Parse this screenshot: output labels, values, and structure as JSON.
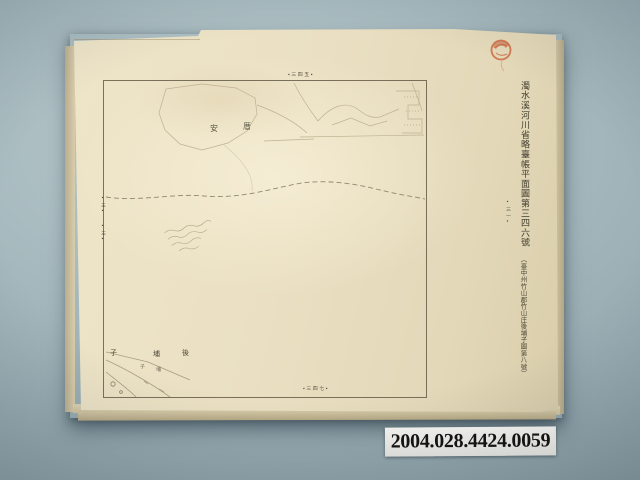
{
  "photo": {
    "backdrop_color": "#a5b8bd",
    "paper_color": "#eadfc2",
    "object_type": "archival cadastral map sheet photographed on blue-gray backdrop"
  },
  "map_sheet": {
    "title_vertical": "濁水溪河川省略臺帳平面圖第三四六號",
    "location_note": "（臺中州竹山郡竹山庄後埔子圖第八號）",
    "margin_note_top": "▪三四五▪",
    "margin_note_bottom": "▪三四七▪",
    "margin_note_left_upper": "▪三▪",
    "margin_note_left_lower": "▪三▪",
    "margin_note_right": "▪三一▪",
    "interior_labels": [
      {
        "text": "安"
      },
      {
        "text": "厝"
      }
    ],
    "place_labels": [
      {
        "text": "子"
      },
      {
        "text": "埔"
      },
      {
        "text": "後"
      }
    ],
    "small_labels": [
      {
        "text": "子"
      },
      {
        "text": "埔"
      }
    ],
    "handwritten_note_present": true,
    "dashed_river_line_present": true,
    "seal_color": "#c55f39"
  },
  "catalog_label": {
    "number": "2004.028.4424.0059"
  }
}
